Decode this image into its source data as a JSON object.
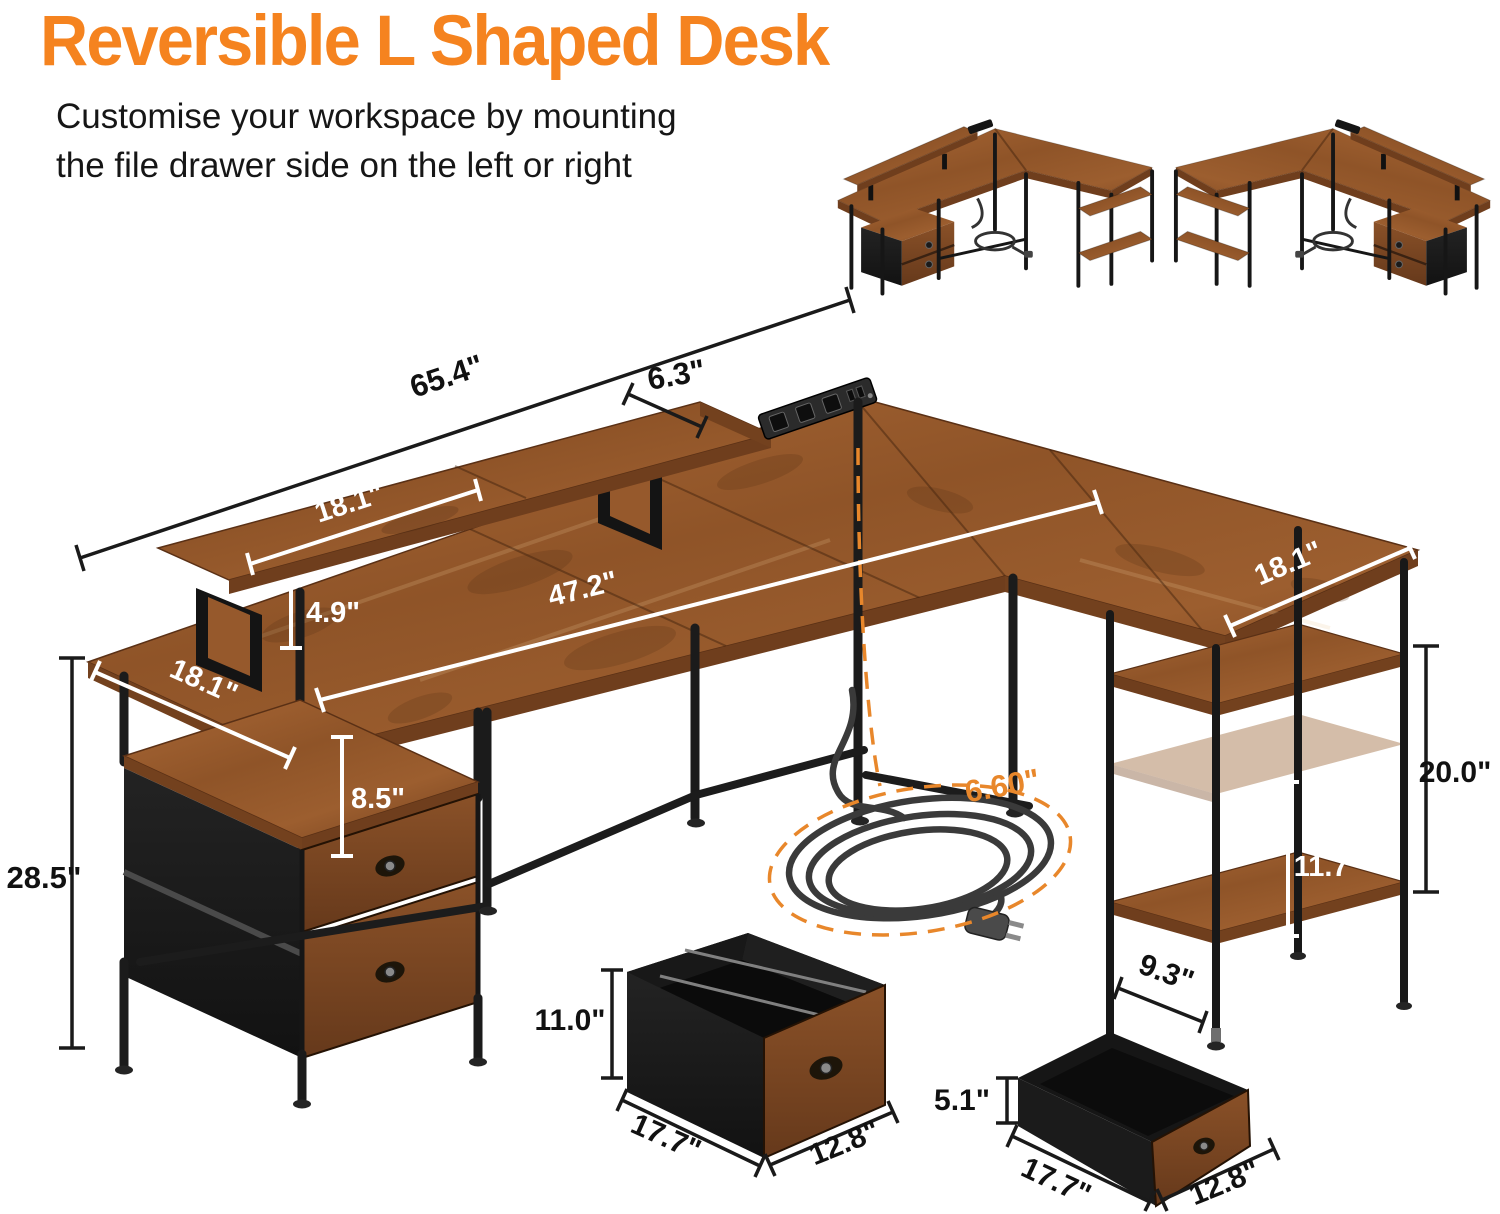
{
  "header": {
    "title": "Reversible L Shaped Desk",
    "subtitle_line1": "Customise your workspace by mounting",
    "subtitle_line2": "the file drawer side on the left or right"
  },
  "colors": {
    "accent": "#F5831F",
    "cord_label": "#E8872B",
    "wood": "#9A5C30",
    "metal": "#1B1B1B",
    "dim_dark": "#111111",
    "dim_light": "#FFFFFF"
  },
  "desk": {
    "overall_width": "65.4\"",
    "monitor_shelf_depth": "6.3\"",
    "monitor_shelf_length": "18.1\"",
    "monitor_shelf_height": "4.9\"",
    "main_top_length": "47.2\"",
    "main_top_depth": "18.1\"",
    "cabinet_opening_height": "8.5\"",
    "overall_height": "28.5\"",
    "right_top_depth": "18.1\"",
    "right_frame_height": "20.0\"",
    "shelf_clearance": "11.7\"",
    "shelf_depth": "9.3\"",
    "power_cord_length": "6.60\""
  },
  "file_drawer": {
    "height": "11.0\"",
    "width": "17.7\"",
    "depth": "12.8\""
  },
  "top_drawer": {
    "height": "5.1\"",
    "width": "17.7\"",
    "depth": "12.8\""
  }
}
